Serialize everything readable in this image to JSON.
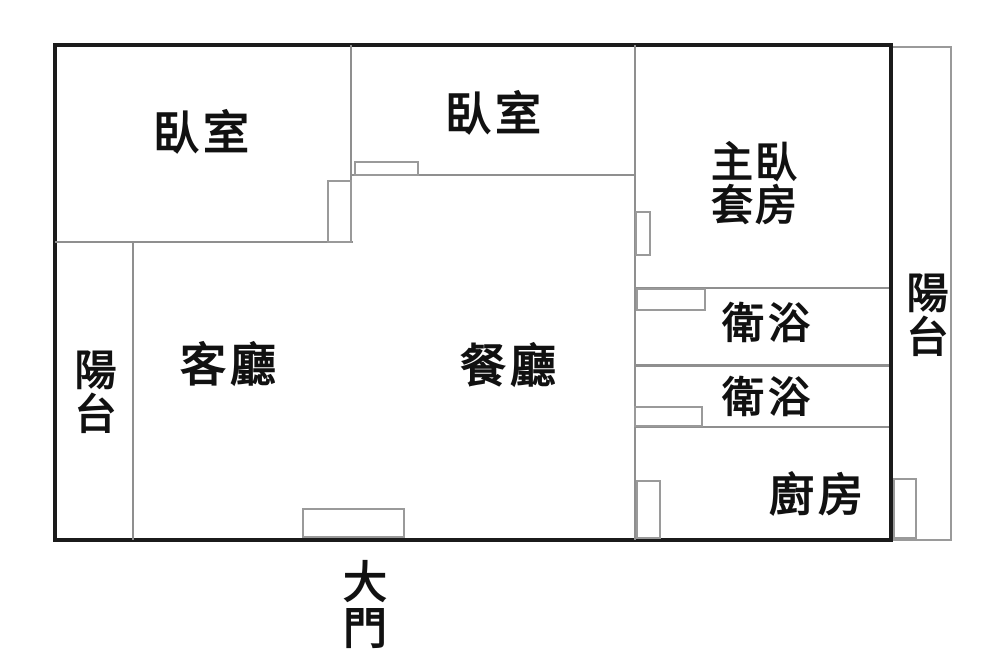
{
  "diagram": {
    "kind": "apartment floor plan",
    "colors": {
      "background": "#ffffff",
      "outer_wall": "#1b1b1b",
      "interior_wall": "#8f8f8f",
      "opening_outline": "#9a9a9a",
      "text": "#111111"
    },
    "rooms": {
      "bedroom1": {
        "label": "臥室"
      },
      "bedroom2": {
        "label": "臥室"
      },
      "master_suite": {
        "label_line1": "主臥",
        "label_line2": "套房"
      },
      "bathroom1": {
        "label": "衛浴"
      },
      "bathroom2": {
        "label": "衛浴"
      },
      "kitchen": {
        "label": "廚房"
      },
      "living_room": {
        "label": "客廳"
      },
      "dining_room": {
        "label": "餐廳"
      },
      "balcony_left": {
        "label": "陽台"
      },
      "balcony_right": {
        "label": "陽台"
      },
      "main_entrance": {
        "label": "大門"
      }
    }
  }
}
